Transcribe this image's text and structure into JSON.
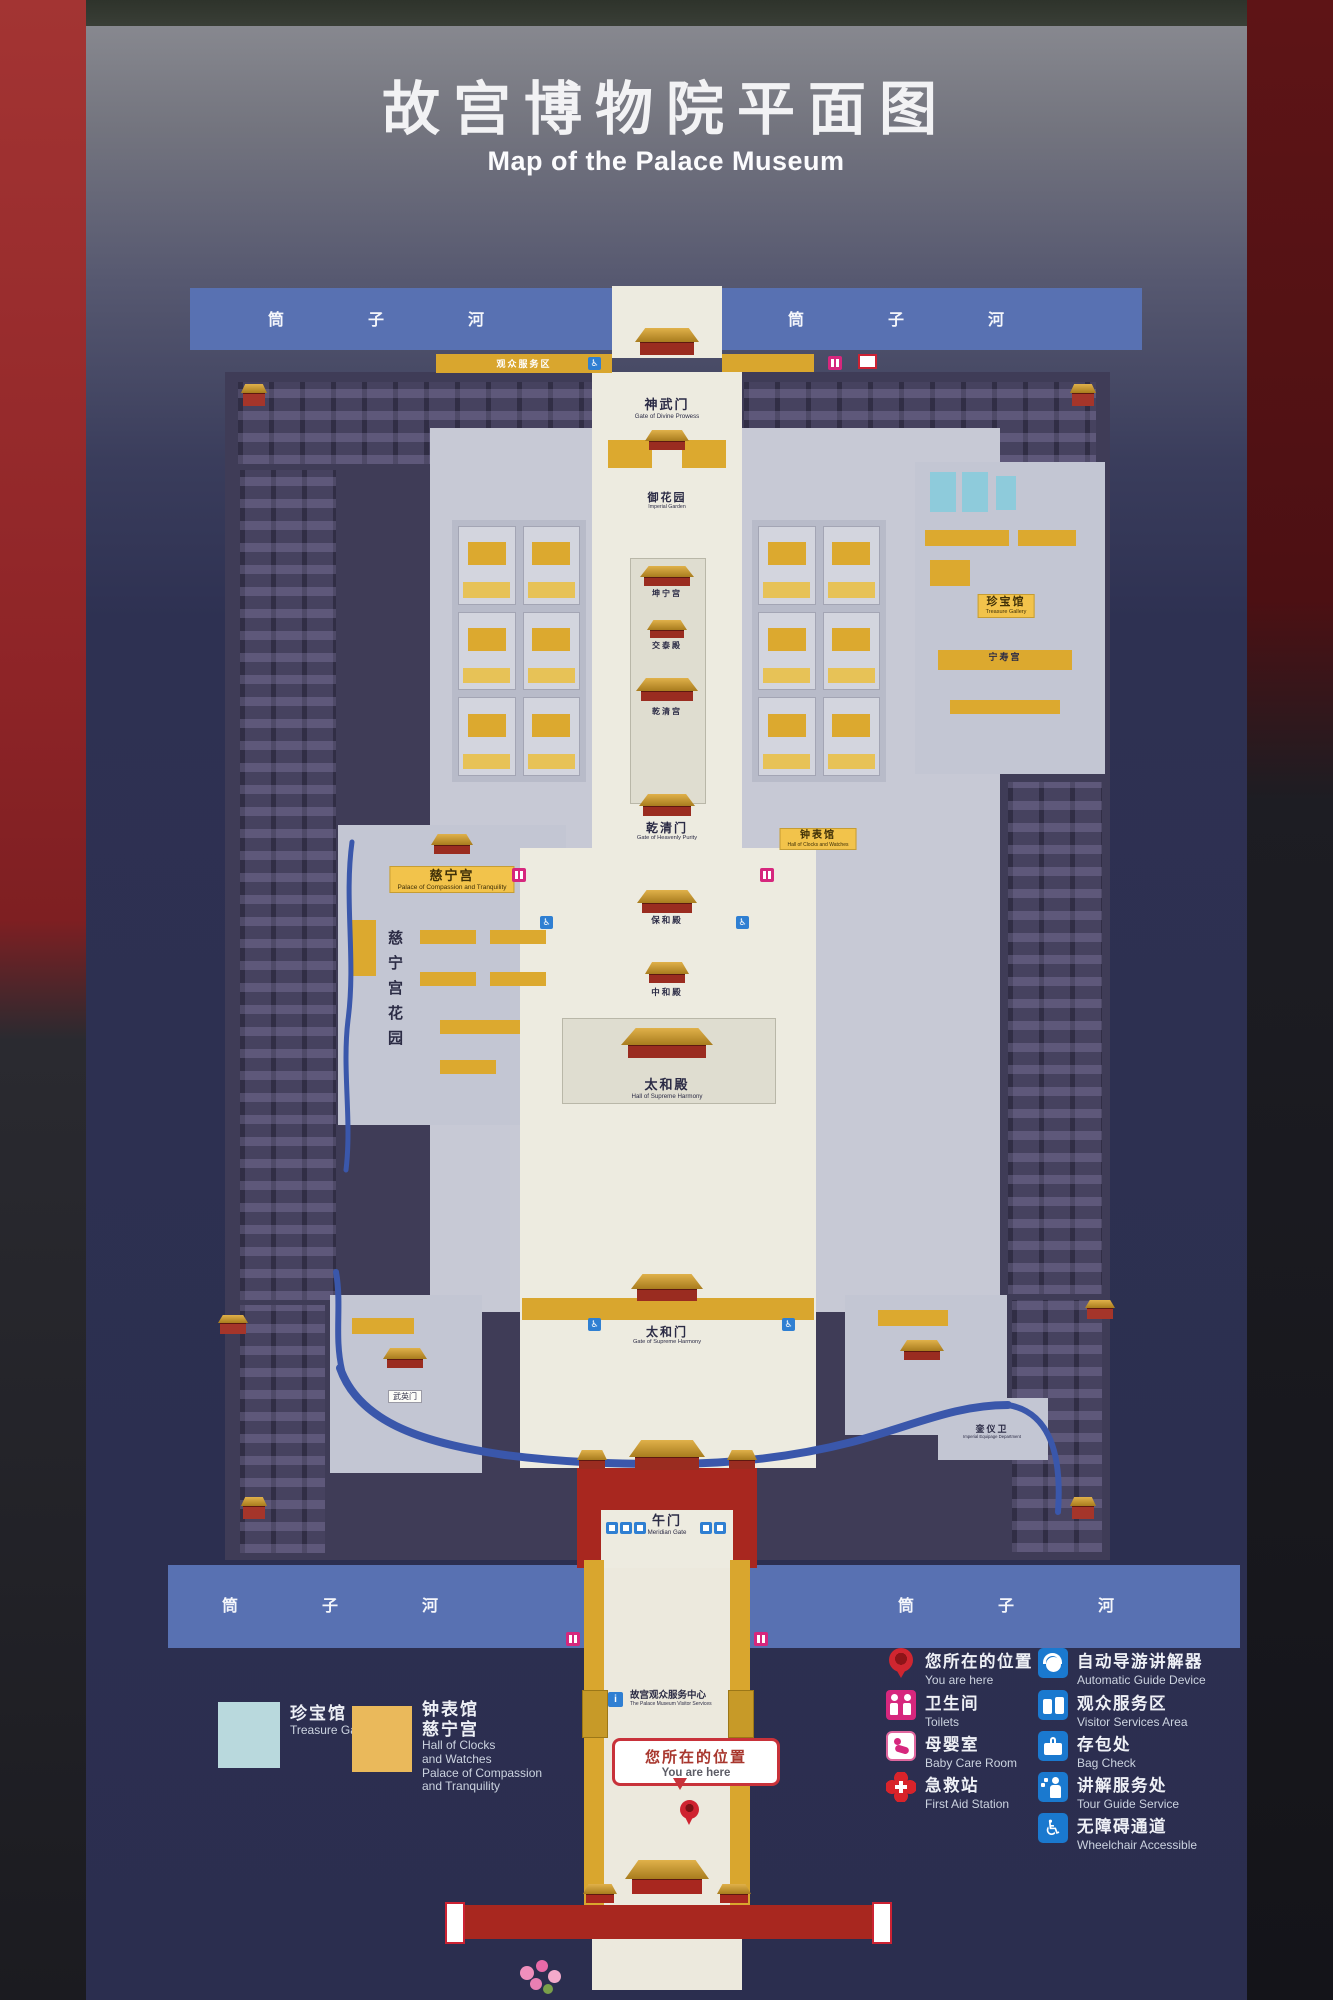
{
  "sign": {
    "title_zh": "故宫博物院平面图",
    "title_en": "Map of the Palace Museum"
  },
  "moat": {
    "zh": "筒子河"
  },
  "map_labels": {
    "shenwumen": {
      "zh": "神武门",
      "en": "Gate of Divine Prowess"
    },
    "service_area": {
      "zh": "观众服务区"
    },
    "yuhuayuan": {
      "zh": "御花园",
      "en": "Imperial Garden"
    },
    "kunninggong": {
      "zh": "坤宁宫"
    },
    "jiaotaidian": {
      "zh": "交泰殿"
    },
    "qianqinggong": {
      "zh": "乾清宫"
    },
    "qianqingmen": {
      "zh": "乾清门",
      "en": "Gate of Heavenly Purity"
    },
    "baohedian": {
      "zh": "保和殿"
    },
    "zhonghedian": {
      "zh": "中和殿"
    },
    "taihedian": {
      "zh": "太和殿",
      "en": "Hall of Supreme Harmony"
    },
    "taihemen": {
      "zh": "太和门",
      "en": "Gate of Supreme Harmony"
    },
    "wumen": {
      "zh": "午门",
      "en": "Meridian Gate"
    },
    "zhenbaoguan": {
      "zh": "珍宝馆",
      "en": "Treasure Gallery"
    },
    "ningshougong": {
      "zh": "宁寿宫"
    },
    "zhongbiaoguan": {
      "zh": "钟表馆",
      "en": "Hall of Clocks and Watches"
    },
    "cininggong": {
      "zh": "慈宁宫",
      "en": "Palace of Compassion and Tranquility"
    },
    "cining_garden": {
      "zh": "慈宁宫花园"
    },
    "wuyingmen": {
      "zh": "武英门"
    },
    "luanyiwei": {
      "zh": "銮仪卫",
      "en": "Imperial Equipage Department"
    },
    "visitor_center": {
      "zh": "故宫观众服务中心",
      "en": "The Palace Museum Visitor Services"
    }
  },
  "you_are_here": {
    "zh": "您所在的位置",
    "en": "You are here"
  },
  "legend": {
    "swatches": [
      {
        "color": "#b9d9dd",
        "zh": "珍宝馆",
        "en": "Treasure Gallery"
      },
      {
        "color": "#eab95b",
        "zh1": "钟表馆",
        "zh2": "慈宁宫",
        "en1": "Hall of Clocks",
        "en2": "and Watches",
        "en3": "Palace of Compassion",
        "en4": "and Tranquility"
      }
    ],
    "left": [
      {
        "icon": "location-pin",
        "zh": "您所在的位置",
        "en": "You are here"
      },
      {
        "icon": "toilets",
        "zh": "卫生间",
        "en": "Toilets"
      },
      {
        "icon": "baby-care",
        "zh": "母婴室",
        "en": "Baby Care Room"
      },
      {
        "icon": "first-aid",
        "zh": "急救站",
        "en": "First Aid Station"
      }
    ],
    "right": [
      {
        "icon": "audio-guide",
        "zh": "自动导游讲解器",
        "en": "Automatic Guide Device"
      },
      {
        "icon": "visitor-services",
        "zh": "观众服务区",
        "en": "Visitor Services Area"
      },
      {
        "icon": "bag-check",
        "zh": "存包处",
        "en": "Bag Check"
      },
      {
        "icon": "tour-guide",
        "zh": "讲解服务处",
        "en": "Tour Guide Service"
      },
      {
        "icon": "wheelchair",
        "zh": "无障碍通道",
        "en": "Wheelchair Accessible"
      }
    ]
  },
  "colors": {
    "board_navy": "#2e3152",
    "moat_blue": "#5871b2",
    "highlight_yellow": "#dca92f",
    "treasure_blue": "#b9d9dd",
    "wall_red": "#a8271f",
    "roof_gold": "#e0b14a",
    "wc_magenta": "#d6277d",
    "service_blue": "#1a79cf",
    "you_are_here_red": "#c8323a"
  }
}
